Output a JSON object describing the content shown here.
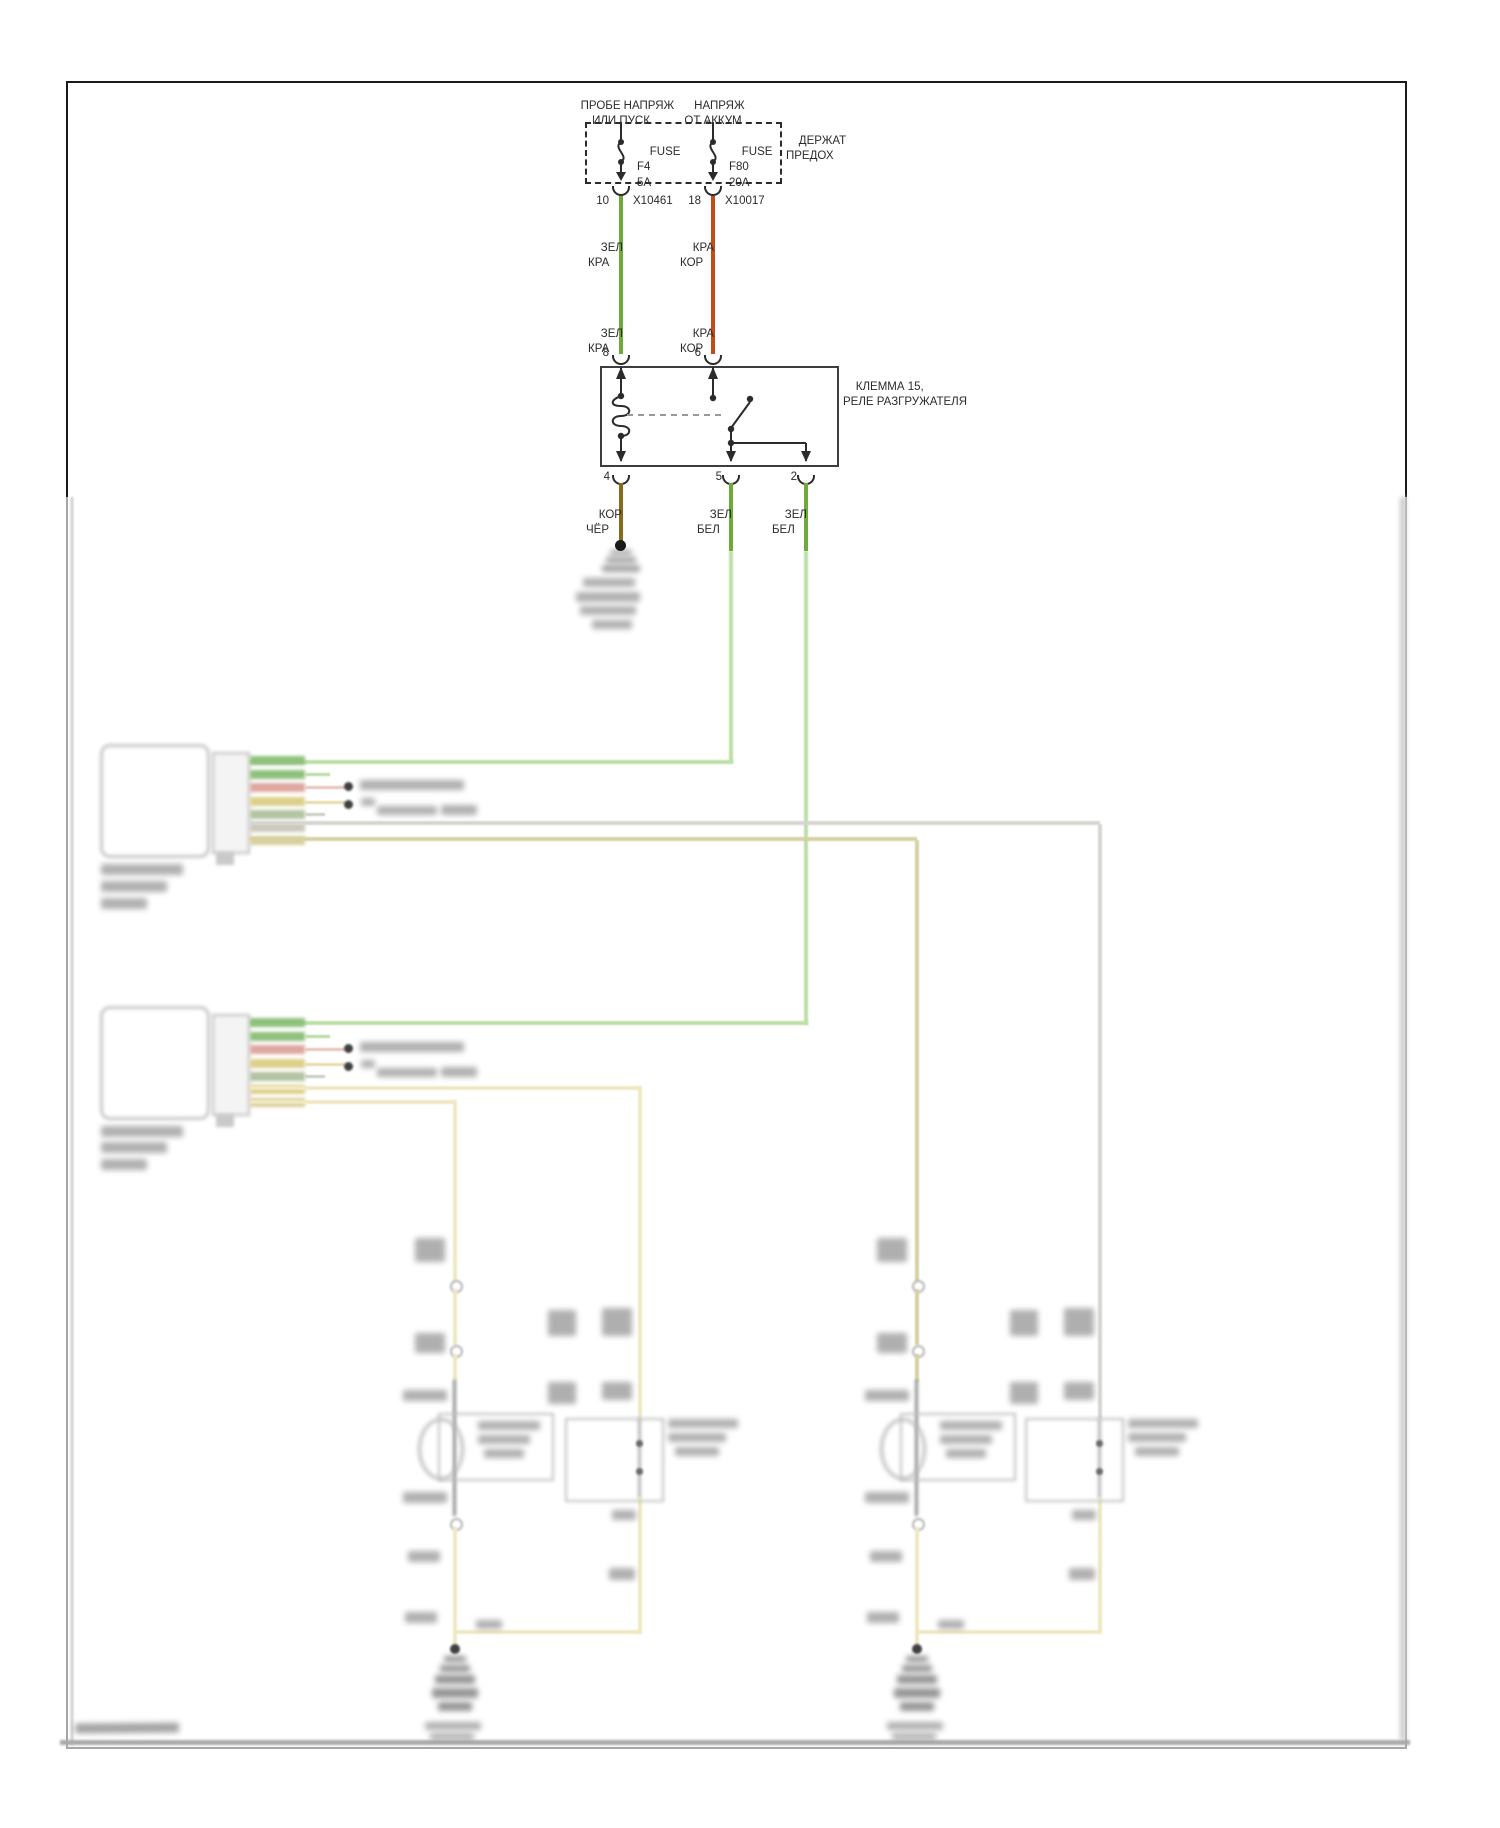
{
  "supply": {
    "left_feed": {
      "line1": "ПРОБЕ НАПРЯЖ",
      "line2": "ИЛИ ПУСК"
    },
    "right_feed": {
      "line1": "НАПРЯЖ",
      "line2": "ОТ АККУМ"
    },
    "holder": {
      "line1": "ДЕРЖАТ",
      "line2": "ПРЕДОХ"
    },
    "fuse1": {
      "line1": "FUSE",
      "line2": "F4",
      "line3": "5A"
    },
    "fuse2": {
      "line1": "FUSE",
      "line2": "F80",
      "line3": "20A"
    },
    "conn1": {
      "pin": "10",
      "code": "X10461"
    },
    "conn2": {
      "pin": "18",
      "code": "X10017"
    }
  },
  "wire_labels": {
    "green_red": {
      "line1": "ЗЕЛ",
      "line2": "КРА"
    },
    "red_brown": {
      "line1": "КРА",
      "line2": "КОР"
    },
    "brown_black": {
      "line1": "КОР",
      "line2": "ЧЁР"
    },
    "green_white": {
      "line1": "ЗЕЛ",
      "line2": "БЕЛ"
    }
  },
  "relay": {
    "title1": "КЛЕММА 15,",
    "title2": "РЕЛЕ РАЗГРУЖАТЕЛЯ",
    "pin_top_left": "8",
    "pin_top_right": "6",
    "pin_bottom": [
      "4",
      "5",
      "2"
    ]
  },
  "colors": {
    "wire_green": "#6cab38",
    "wire_red": "#c64a1c",
    "wire_brown": "#8a6a1a",
    "wire_green_faded": "#bce0a6",
    "wire_yellow_faded": "#efe9c2",
    "wire_olive_faded": "#d6d2a2",
    "wire_grey_faded": "#d6d6d0",
    "line_dark": "#2b2b2b"
  }
}
